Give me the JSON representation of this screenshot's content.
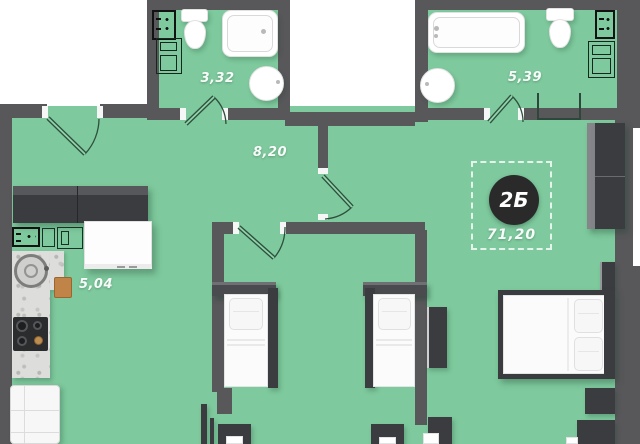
{
  "plan": {
    "type": "apartment-floor-plan",
    "unit": {
      "badge": "2Б",
      "total_area": "71,20"
    },
    "rooms": {
      "bathroom_small": {
        "area": "3,32"
      },
      "bathroom_large": {
        "area": "5,39"
      },
      "hallway": {
        "area": "8,20"
      },
      "kitchen": {
        "area": "5,04"
      }
    },
    "colors": {
      "floor": "#7ec99d",
      "walls": "#58585a",
      "furniture_dark": "#3b3c3f",
      "fixtures_white": "#ffffff",
      "badge_background": "#2a2a2b",
      "label_text": "#ffffff"
    },
    "fixtures": [
      "bathtub",
      "toilet",
      "sink",
      "washing-machine",
      "electric-panel-icon",
      "shower-screen",
      "cooktop",
      "fridge",
      "kitchen-counter",
      "sofa",
      "single-bed",
      "double-bed",
      "wardrobe",
      "desk",
      "chair",
      "door-swing-icon"
    ]
  }
}
